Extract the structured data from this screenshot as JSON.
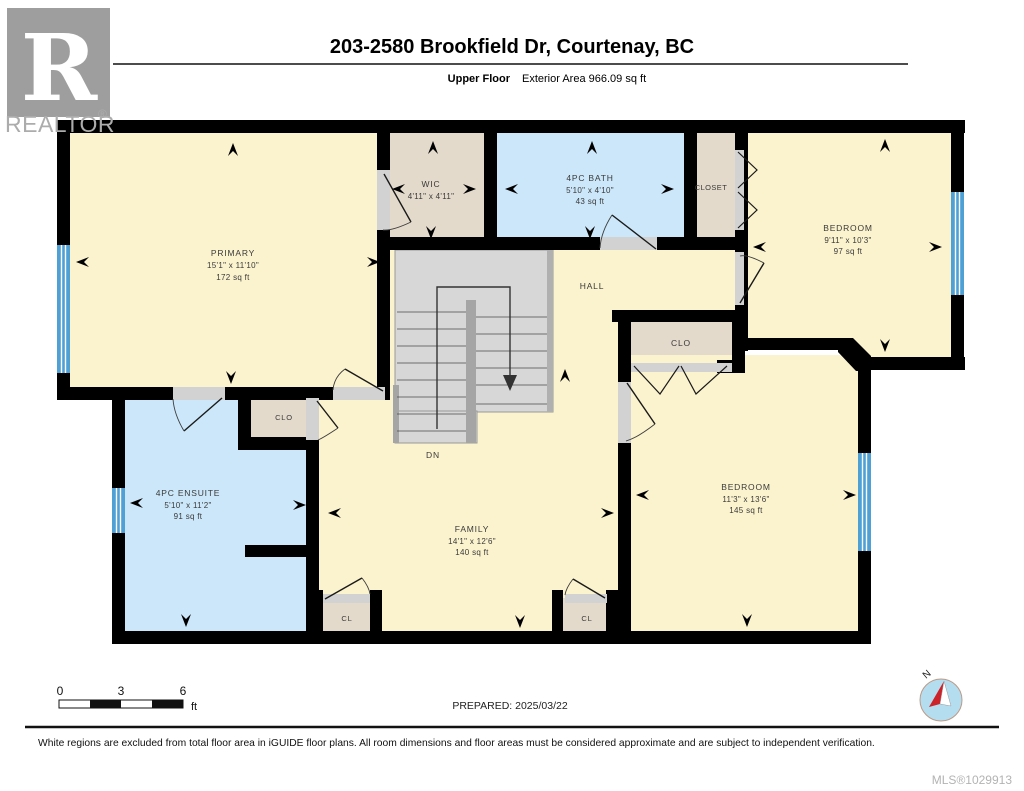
{
  "header": {
    "title": "203-2580 Brookfield Dr, Courtenay, BC",
    "floor_label": "Upper Floor",
    "area_label": "Exterior Area 966.09 sq ft"
  },
  "logo": {
    "letter": "R",
    "brand": "REALTOR",
    "reg": "®"
  },
  "rooms": {
    "primary": {
      "name": "PRIMARY",
      "dims": "15'1\" x 11'10\"",
      "area": "172 sq ft"
    },
    "wic": {
      "name": "WIC",
      "dims": "4'11\" x 4'11\""
    },
    "bath": {
      "name": "4PC BATH",
      "dims": "5'10\" x 4'10\"",
      "area": "43 sq ft"
    },
    "closet": {
      "name": "CLOSET"
    },
    "bedroom_ne": {
      "name": "BEDROOM",
      "dims": "9'11\" x 10'3\"",
      "area": "97 sq ft"
    },
    "hall": {
      "name": "HALL"
    },
    "clo_hall": {
      "name": "CLO"
    },
    "clo_ensuite": {
      "name": "CLO"
    },
    "ensuite": {
      "name": "4PC ENSUITE",
      "dims": "5'10\" x 11'2\"",
      "area": "91 sq ft"
    },
    "family": {
      "name": "FAMILY",
      "dims": "14'1\" x 12'6\"",
      "area": "140 sq ft"
    },
    "bedroom_se": {
      "name": "BEDROOM",
      "dims": "11'3\" x 13'6\"",
      "area": "145 sq ft"
    },
    "cl_left": {
      "name": "CL"
    },
    "cl_right": {
      "name": "CL"
    },
    "stairs": {
      "dn": "DN"
    }
  },
  "scalebar": {
    "t0": "0",
    "t1": "3",
    "t2": "6",
    "unit": "ft"
  },
  "prepared": {
    "text": "PREPARED: 2025/03/22"
  },
  "compass": {
    "n": "N"
  },
  "footer": {
    "disclaimer": "White regions are excluded from total floor area in iGUIDE floor plans. All room dimensions and floor areas must be considered approximate and are subject to independent verification.",
    "mls": "MLS®1029913"
  },
  "colors": {
    "floor": "#FBF2CE",
    "closet": "#E3DACB",
    "wet": "#CBE7F9",
    "stairs": "#D7D7D7",
    "window": "#4FA0D5",
    "wall": "#000000"
  }
}
